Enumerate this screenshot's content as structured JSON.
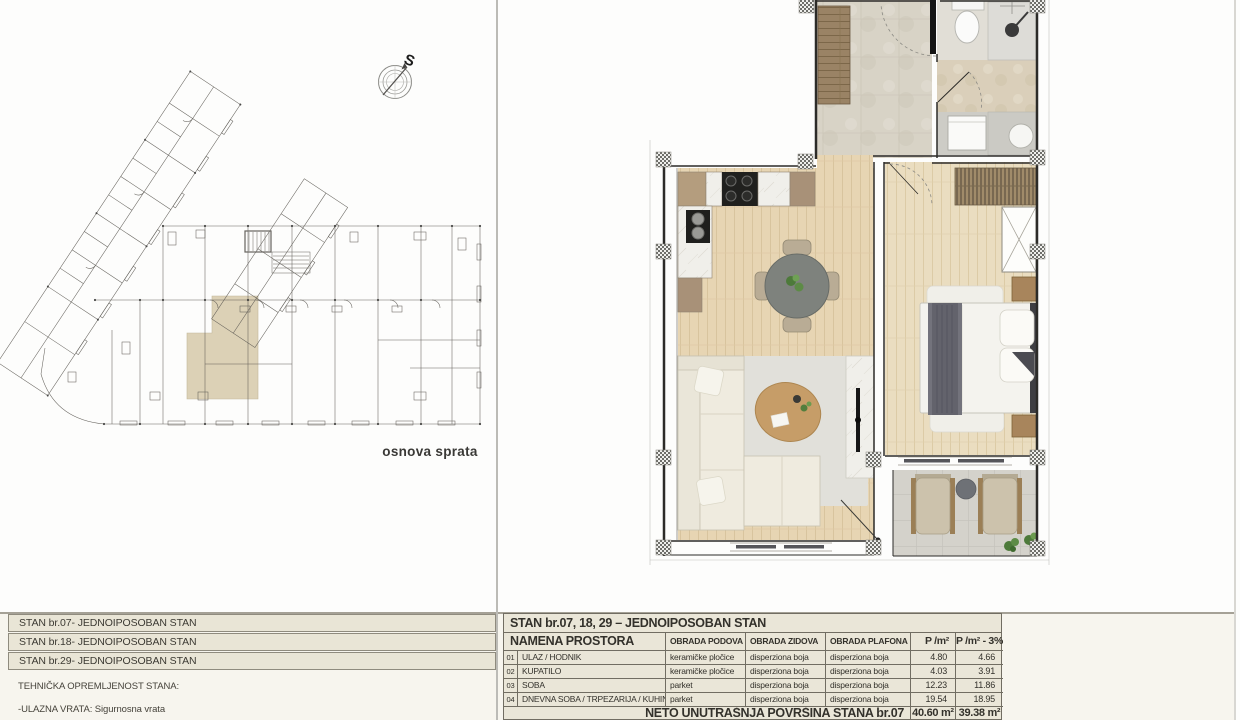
{
  "left_panel": {
    "compass_letter": "S",
    "plan_label": "osnova sprata",
    "apartment_list": [
      {
        "label": "STAN br.07- JEDNOIPOSOBAN STAN"
      },
      {
        "label": "STAN br.18- JEDNOIPOSOBAN STAN"
      },
      {
        "label": "STAN br.29- JEDNOIPOSOBAN STAN"
      }
    ],
    "tech_section": {
      "title": "TEHNIČKA OPREMLJENOST STANA:",
      "items": [
        {
          "label": "-ULAZNA VRATA: Sigurnosna vrata"
        }
      ]
    }
  },
  "right_panel": {
    "spec_table": {
      "title": "STAN br.07, 18, 29 – JEDNOIPOSOBAN STAN",
      "columns": {
        "name": "NAMENA PROSTORA",
        "floor": "OBRADA PODOVA",
        "walls": "OBRADA ZIDOVA",
        "ceiling": "OBRADA PLAFONA",
        "area": "P /m²",
        "area_reduced": "P /m² - 3%"
      },
      "rows": [
        {
          "num": "01",
          "name": "ULAZ / HODNIK",
          "floor": "keramičke pločice",
          "walls": "disperziona boja",
          "ceiling": "disperziona boja",
          "area": "4.80",
          "area_reduced": "4.66"
        },
        {
          "num": "02",
          "name": "KUPATILO",
          "floor": "keramičke pločice",
          "walls": "disperziona boja",
          "ceiling": "disperziona boja",
          "area": "4.03",
          "area_reduced": "3.91"
        },
        {
          "num": "03",
          "name": "SOBA",
          "floor": "parket",
          "walls": "disperziona boja",
          "ceiling": "disperziona boja",
          "area": "12.23",
          "area_reduced": "11.86"
        },
        {
          "num": "04",
          "name": "DNEVNA SOBA / TRPEZARIJA / KUHINJA",
          "floor": "parket",
          "walls": "disperziona boja",
          "ceiling": "disperziona boja",
          "area": "19.54",
          "area_reduced": "18.95"
        }
      ],
      "footer": {
        "label": "NETO UNUTRAŠNJA POVRŠINA STANA br.07",
        "area_total": "40.60 m²",
        "area_reduced_total": "39.38 m²"
      }
    }
  },
  "icons": {
    "compass-icon": "circled compass rose with needle pointing to S (sever/north)"
  },
  "colors": {
    "row_fill": "#e9e5d6",
    "table_border": "#716d62",
    "unit_highlight": "#dcd1b6",
    "wood_floor": "#e7d5b3",
    "wood_floor_light": "#eaddc0",
    "stone_tile": "#d8d3c6",
    "terrace_tile": "#d4d2cb",
    "blanket_gray": "#63636c",
    "plant_green": "#4d7a3a"
  }
}
